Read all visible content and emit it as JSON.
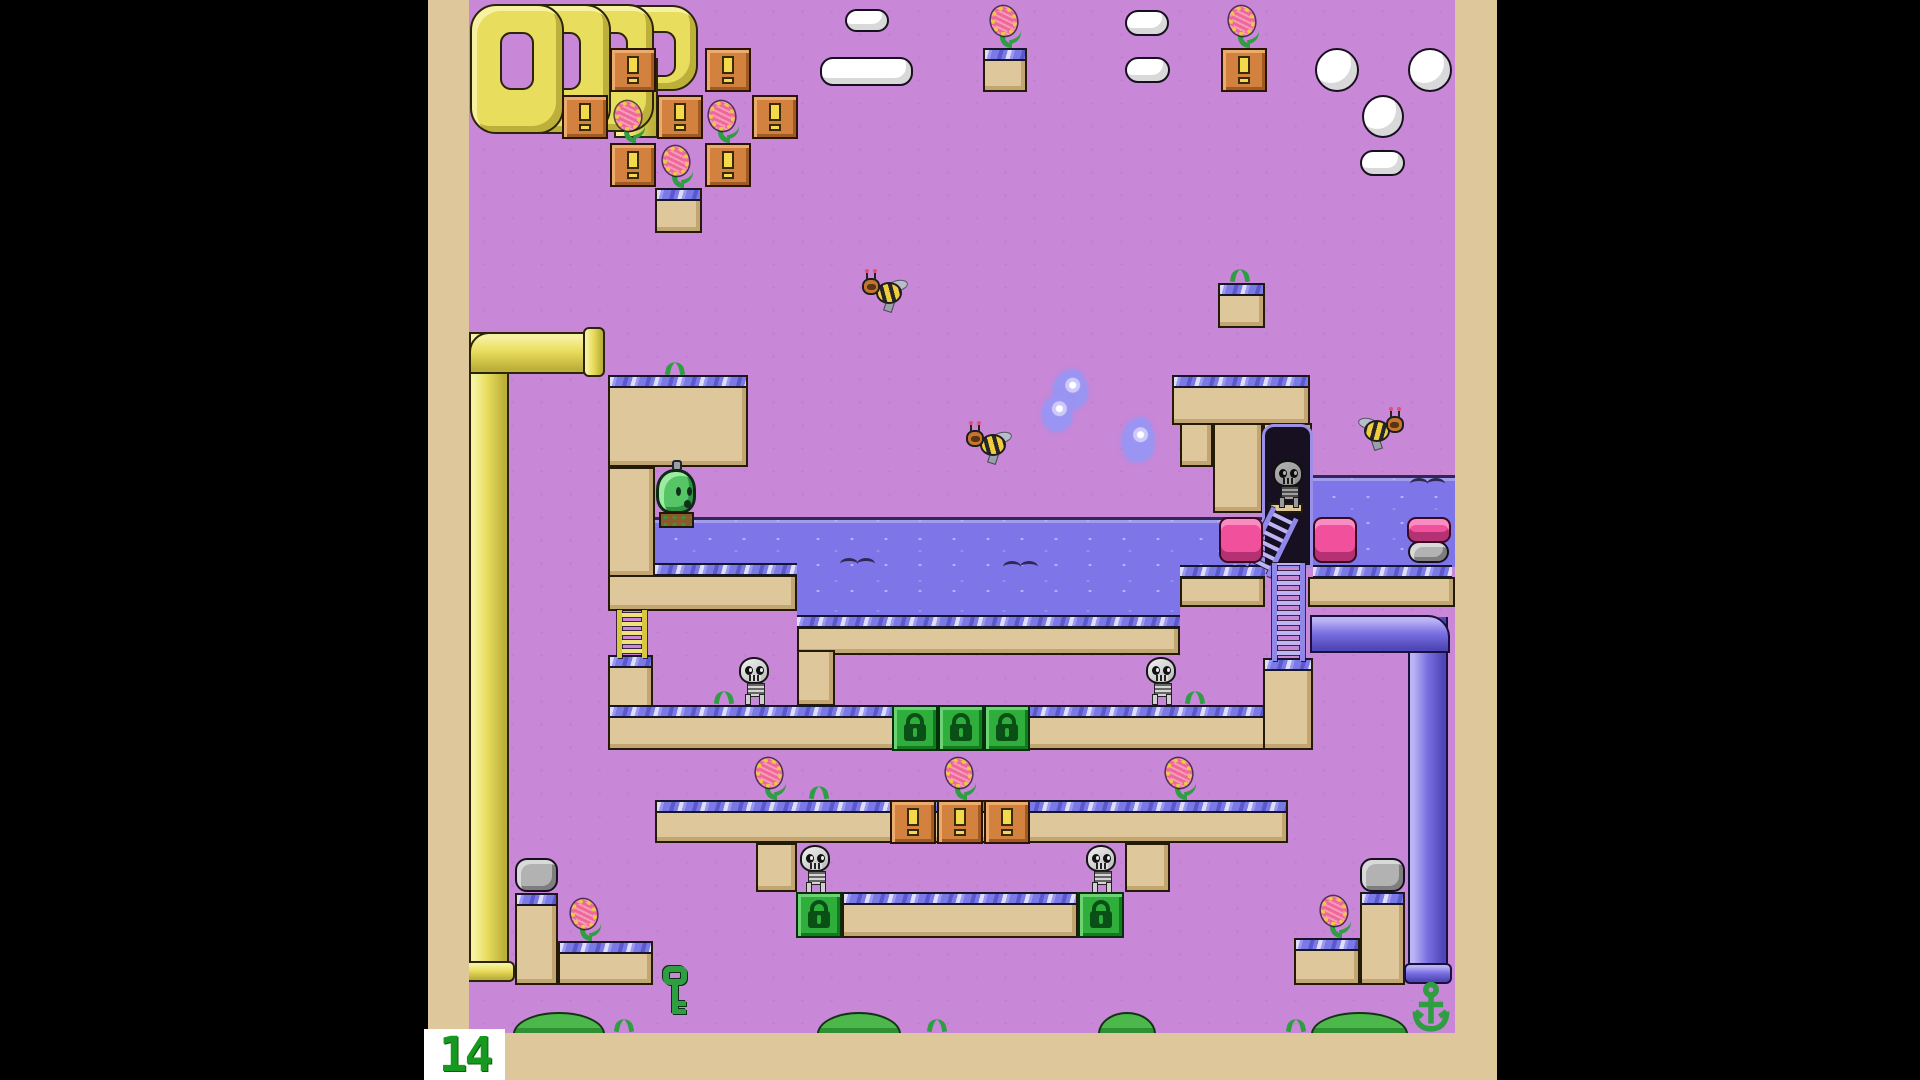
{
  "hud": {
    "counter": "14"
  },
  "colors": {
    "background_sky": "#c987d8",
    "frame_tan": "#dfc79c",
    "outline": "#241a08",
    "water": "#7e76e8",
    "edge_band": "#7b79e6",
    "pipe_yellow": "#e9dd5e",
    "pipe_blue": "#7a70e2",
    "pipe_pink": "#f0509c",
    "block_orange": "#d2823e",
    "block_lock_green": "#2fae3c",
    "player_green": "#56c566",
    "hud_green": "#17991f",
    "cloud_white": "#ffffff"
  },
  "icons": {
    "orange_block_icon": "exclamation-mark",
    "lock_block_icon": "padlock",
    "key_item_icon": "key",
    "anchor_item_icon": "anchor"
  },
  "scene": {
    "platforms": [
      {
        "n": "upper-left-slab",
        "x": 608,
        "y": 375,
        "w": 140,
        "h": 92,
        "e": true
      },
      {
        "n": "left-wall-column",
        "x": 608,
        "y": 467,
        "w": 47,
        "h": 110,
        "e": false
      },
      {
        "n": "shallow-pool-underside",
        "x": 608,
        "y": 575,
        "w": 189,
        "h": 36,
        "e": false
      },
      {
        "n": "deep-pool-underside",
        "x": 797,
        "y": 627,
        "w": 383,
        "h": 28,
        "e": false
      },
      {
        "n": "deep-pool-left-column",
        "x": 797,
        "y": 650,
        "w": 38,
        "h": 56,
        "e": false
      },
      {
        "n": "cove-strip",
        "x": 1180,
        "y": 577,
        "w": 85,
        "h": 30,
        "e": false
      },
      {
        "n": "rightpool-strip",
        "x": 1308,
        "y": 577,
        "w": 147,
        "h": 30,
        "e": false
      },
      {
        "n": "upper-right-slab",
        "x": 1172,
        "y": 375,
        "w": 138,
        "h": 50,
        "e": true
      },
      {
        "n": "upper-right-sub-a",
        "x": 1180,
        "y": 423,
        "w": 33,
        "h": 44,
        "e": false
      },
      {
        "n": "upper-right-sub-b",
        "x": 1213,
        "y": 423,
        "w": 50,
        "h": 90,
        "e": false
      },
      {
        "n": "doorway-column",
        "x": 1263,
        "y": 423,
        "w": 49,
        "h": 144,
        "e": false
      },
      {
        "n": "mid-left-step",
        "x": 608,
        "y": 655,
        "w": 45,
        "h": 95,
        "e": true
      },
      {
        "n": "mid-slab",
        "x": 608,
        "y": 705,
        "w": 705,
        "h": 45,
        "e": true
      },
      {
        "n": "mid-right-step",
        "x": 1263,
        "y": 658,
        "w": 50,
        "h": 92,
        "e": true
      },
      {
        "n": "flower-row-slab",
        "x": 655,
        "y": 800,
        "w": 633,
        "h": 43,
        "e": true
      },
      {
        "n": "tier2-left-column",
        "x": 756,
        "y": 843,
        "w": 41,
        "h": 49,
        "e": false
      },
      {
        "n": "tier2-right-column",
        "x": 1125,
        "y": 843,
        "w": 45,
        "h": 49,
        "e": false
      },
      {
        "n": "lockbar-slab",
        "x": 842,
        "y": 892,
        "w": 236,
        "h": 46,
        "e": true
      },
      {
        "n": "stair-left-column",
        "x": 515,
        "y": 893,
        "w": 43,
        "h": 92,
        "e": true
      },
      {
        "n": "stair-left-slab",
        "x": 558,
        "y": 941,
        "w": 95,
        "h": 44,
        "e": true
      },
      {
        "n": "stair-right-column",
        "x": 1360,
        "y": 892,
        "w": 45,
        "h": 93,
        "e": true
      },
      {
        "n": "stair-right-slab",
        "x": 1294,
        "y": 938,
        "w": 66,
        "h": 47,
        "e": true
      },
      {
        "n": "float-block-cluster",
        "x": 655,
        "y": 188,
        "w": 47,
        "h": 45,
        "e": true
      },
      {
        "n": "float-block-topcenter",
        "x": 983,
        "y": 48,
        "w": 44,
        "h": 44,
        "e": true
      },
      {
        "n": "float-block-grasstop",
        "x": 1218,
        "y": 283,
        "w": 47,
        "h": 45,
        "e": true
      }
    ],
    "water": [
      {
        "x": 655,
        "y": 517,
        "w": 142,
        "h": 48
      },
      {
        "x": 797,
        "y": 517,
        "w": 383,
        "h": 100
      },
      {
        "x": 1180,
        "y": 517,
        "w": 84,
        "h": 50
      },
      {
        "x": 1313,
        "y": 475,
        "w": 142,
        "h": 92
      }
    ],
    "edges": [
      {
        "x": 655,
        "y": 563,
        "w": 142
      },
      {
        "x": 797,
        "y": 615,
        "w": 383
      },
      {
        "x": 1180,
        "y": 565,
        "w": 85
      },
      {
        "x": 1313,
        "y": 565,
        "w": 139
      },
      {
        "x": 469,
        "y": 1033,
        "w": 986
      }
    ],
    "squiggles": [
      [
        840,
        558
      ],
      [
        1003,
        561
      ],
      [
        1410,
        478
      ]
    ],
    "blocks_orange": [
      [
        610,
        48
      ],
      [
        705,
        48
      ],
      [
        562,
        95
      ],
      [
        657,
        95
      ],
      [
        752,
        95
      ],
      [
        610,
        143
      ],
      [
        705,
        143
      ],
      [
        1221,
        48
      ],
      [
        890,
        800
      ],
      [
        937,
        800
      ],
      [
        984,
        800
      ]
    ],
    "blocks_lock": [
      [
        892,
        705
      ],
      [
        938,
        705
      ],
      [
        984,
        705
      ],
      [
        796,
        892
      ],
      [
        1078,
        892
      ]
    ],
    "flowers": [
      [
        612,
        101
      ],
      [
        706,
        101
      ],
      [
        660,
        146
      ],
      [
        988,
        6
      ],
      [
        1226,
        6
      ],
      [
        753,
        758
      ],
      [
        943,
        758
      ],
      [
        1163,
        758
      ],
      [
        568,
        899
      ],
      [
        1318,
        896
      ]
    ],
    "grass": [
      [
        663,
        361
      ],
      [
        1228,
        268
      ],
      [
        712,
        690
      ],
      [
        1183,
        690
      ],
      [
        807,
        785
      ],
      [
        612,
        1018
      ],
      [
        925,
        1018
      ],
      [
        1284,
        1018
      ]
    ],
    "skeletons": [
      [
        738,
        657
      ],
      [
        1145,
        657
      ],
      [
        799,
        845
      ],
      [
        1085,
        845
      ]
    ],
    "door_skeleton": {
      "x": 1272,
      "y": 460
    },
    "bees": [
      {
        "x": 862,
        "y": 272,
        "dir": "left"
      },
      {
        "x": 966,
        "y": 424,
        "dir": "left"
      },
      {
        "x": 1358,
        "y": 410,
        "dir": "right"
      }
    ],
    "clouds": [
      [
        845,
        9,
        44,
        23
      ],
      [
        820,
        57,
        93,
        29
      ],
      [
        1125,
        10,
        44,
        26
      ],
      [
        1125,
        57,
        45,
        26
      ],
      [
        1360,
        150,
        45,
        26
      ]
    ],
    "eggs": [
      [
        1315,
        48,
        44,
        44
      ],
      [
        1408,
        48,
        44,
        44
      ],
      [
        1362,
        95,
        42,
        43
      ]
    ],
    "gray_capsules": [
      [
        515,
        858,
        43,
        34
      ],
      [
        1360,
        858,
        45,
        34
      ],
      [
        1408,
        541,
        41,
        22
      ]
    ],
    "pink_pipes": [
      [
        1219,
        517,
        44,
        46
      ],
      [
        1313,
        517,
        44,
        46
      ],
      [
        1407,
        517,
        44,
        26
      ]
    ],
    "pipe_loops": [
      [
        612,
        5,
        86,
        86
      ],
      [
        564,
        4,
        90,
        128
      ],
      [
        517,
        4,
        94,
        130
      ],
      [
        470,
        4,
        94,
        130
      ]
    ],
    "pipe_loop_tail": {
      "x": 614,
      "y": 58,
      "w": 44,
      "h": 80
    },
    "pipe_yellow": {
      "v": [
        469,
        332,
        40,
        631
      ],
      "h": [
        469,
        332,
        116,
        42
      ],
      "rim": [
        583,
        327,
        22,
        50
      ],
      "cap": [
        463,
        961,
        52,
        21
      ]
    },
    "pipe_blue": {
      "v": [
        1408,
        617,
        40,
        348
      ],
      "h": [
        1310,
        615,
        140,
        38
      ],
      "cap": [
        1404,
        963,
        48,
        21
      ]
    },
    "ladders": [
      {
        "type": "yellow",
        "x": 617,
        "y": 610,
        "w": 30,
        "h": 48,
        "rot": 0
      },
      {
        "type": "purple",
        "x": 1256,
        "y": 510,
        "w": 30,
        "h": 64,
        "rot": 26
      },
      {
        "type": "purple",
        "x": 1272,
        "y": 563,
        "w": 33,
        "h": 98,
        "rot": 0
      }
    ],
    "doorway": {
      "x": 1262,
      "y": 424,
      "w": 51,
      "h": 144
    },
    "player": {
      "x": 656,
      "y": 460
    },
    "key": {
      "x": 663,
      "y": 966
    },
    "anchor": {
      "x": 1409,
      "y": 982,
      "w": 44,
      "h": 52
    },
    "bushes": [
      [
        513,
        1012,
        92,
        22
      ],
      [
        817,
        1012,
        84,
        22
      ],
      [
        1098,
        1012,
        58,
        22
      ],
      [
        1311,
        1012,
        97,
        22
      ]
    ],
    "wisps": [
      [
        1053,
        370,
        34,
        40
      ],
      [
        1042,
        395,
        30,
        36
      ],
      [
        1122,
        418,
        32,
        44
      ]
    ]
  }
}
